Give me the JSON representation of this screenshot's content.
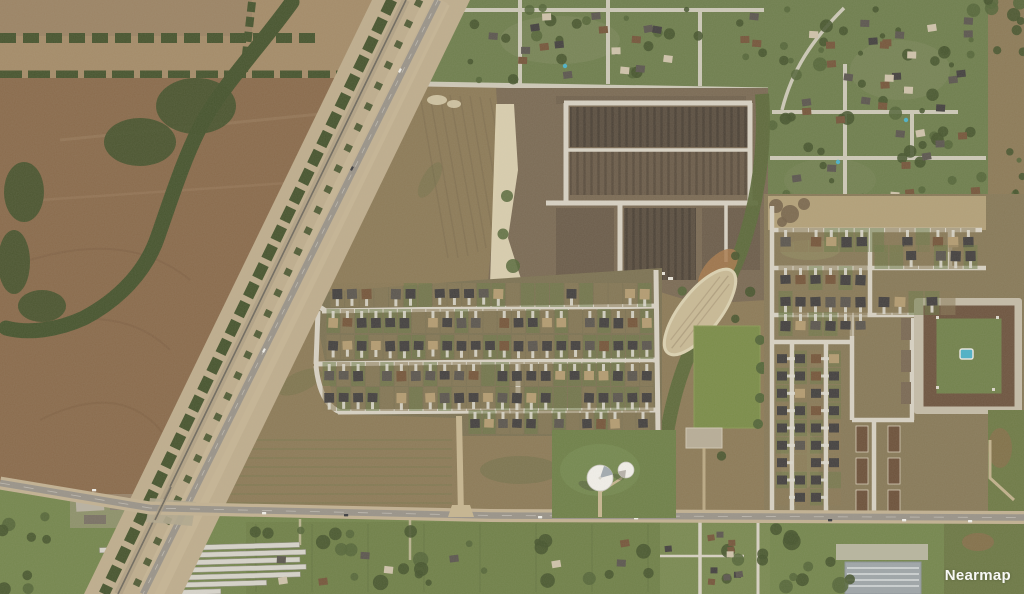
{
  "watermark": {
    "label": "Nearmap"
  },
  "map": {
    "type": "aerial-imagery",
    "scene": "suburban development: farmland, rail and road corridor, construction site, new subdivisions, water towers, east-west arterial road"
  },
  "palette": {
    "field_tan": "#a58c69",
    "field_tan2": "#9c8465",
    "field_brown": "#8a6b4c",
    "field_brown_dark": "#7d6043",
    "field_olive": "#8d7b58",
    "grass_green": "#6f7f4e",
    "lawn_green": "#6f8149",
    "sports_green": "#7b8d49",
    "tree_dark": "#47552f",
    "tree_mid": "#55673a",
    "scrub_olive": "#5e6c3c",
    "corridor_dirt": "#bfae8e",
    "ballast": "#b2a286",
    "rail_gray": "#6f6a5f",
    "road_asphalt": "#9a948a",
    "road_shoulder": "#c3b293",
    "street_light": "#d8d2c4",
    "dirt_road": "#c7b691",
    "construction_base": "#7b6b55",
    "construction_dark": "#5b4f41",
    "construction_mid": "#6c5d4b",
    "sand_pale": "#ded4b4",
    "detention_tan": "#c9ba96",
    "rust_dirt": "#a87a4e",
    "apt_pad": "#c5bca8",
    "apt_roof": "#6e5540",
    "courtyard": "#72824c",
    "pool_blue": "#4db2c8",
    "tower_white": "#f2f0ea",
    "tower_shadow": "#8e9aa3",
    "roof_dark": "#444140",
    "roof_gray": "#5c5750",
    "roof_brown": "#76573c",
    "roof_tan": "#b49c72",
    "roof_light": "#cfc3ab",
    "driveway": "#dcd8cd",
    "storage_roof": "#d7d4cb",
    "bldg_gray": "#9fa6a9",
    "south_green": "#75874e",
    "dirt_patch": "#8a6f4c",
    "watermark": "#ffffff"
  },
  "generated": {
    "house_rows": [
      {
        "x0": 330,
        "x1": 652,
        "y": 289,
        "n": 22,
        "face": "s",
        "skip": 0.28,
        "seed": 11
      },
      {
        "x0": 326,
        "x1": 654,
        "y": 318,
        "n": 23,
        "face": "n",
        "skip": 0.08,
        "seed": 12
      },
      {
        "x0": 326,
        "x1": 654,
        "y": 341,
        "n": 23,
        "face": "s",
        "skip": 0.08,
        "seed": 13
      },
      {
        "x0": 322,
        "x1": 654,
        "y": 371,
        "n": 23,
        "face": "n",
        "skip": 0.1,
        "seed": 14
      },
      {
        "x0": 322,
        "x1": 654,
        "y": 393,
        "n": 23,
        "face": "s",
        "skip": 0.1,
        "seed": 15
      },
      {
        "x0": 468,
        "x1": 650,
        "y": 419,
        "n": 13,
        "face": "n",
        "skip": 0.15,
        "seed": 16
      },
      {
        "x0": 778,
        "x1": 976,
        "y": 237,
        "n": 13,
        "face": "n",
        "skip": 0.35,
        "seed": 21
      },
      {
        "x0": 874,
        "x1": 978,
        "y": 251,
        "n": 7,
        "face": "s",
        "skip": 0.15,
        "seed": 22
      },
      {
        "x0": 778,
        "x1": 868,
        "y": 275,
        "n": 6,
        "face": "n",
        "skip": 0.1,
        "seed": 23
      },
      {
        "x0": 778,
        "x1": 868,
        "y": 297,
        "n": 6,
        "face": "s",
        "skip": 0.1,
        "seed": 24
      },
      {
        "x0": 876,
        "x1": 956,
        "y": 297,
        "n": 5,
        "face": "s",
        "skip": 0.2,
        "seed": 25
      },
      {
        "x0": 778,
        "x1": 868,
        "y": 321,
        "n": 6,
        "face": "n",
        "skip": 0.1,
        "seed": 26
      }
    ],
    "house_columns": [
      {
        "x": 782,
        "y0": 350,
        "y1": 506,
        "n": 9,
        "face": "e",
        "skip": 0.12,
        "seed": 31
      },
      {
        "x": 800,
        "y0": 350,
        "y1": 506,
        "n": 9,
        "face": "w",
        "skip": 0.12,
        "seed": 32
      },
      {
        "x": 816,
        "y0": 350,
        "y1": 506,
        "n": 9,
        "face": "e",
        "skip": 0.12,
        "seed": 33
      },
      {
        "x": 834,
        "y0": 350,
        "y1": 506,
        "n": 9,
        "face": "w",
        "skip": 0.12,
        "seed": 34
      }
    ],
    "tree_scatters": [
      {
        "x0": 458,
        "y0": 6,
        "x1": 764,
        "y1": 80,
        "n": 26,
        "rmin": 2.5,
        "rmax": 6,
        "seed": 41
      },
      {
        "x0": 772,
        "y0": 4,
        "x1": 984,
        "y1": 214,
        "n": 55,
        "rmin": 2.5,
        "rmax": 7,
        "seed": 42
      },
      {
        "x0": 988,
        "y0": 0,
        "x1": 1024,
        "y1": 52,
        "n": 9,
        "rmin": 3,
        "rmax": 7,
        "seed": 43
      },
      {
        "x0": 1002,
        "y0": 150,
        "x1": 1024,
        "y1": 228,
        "n": 7,
        "rmin": 2.5,
        "rmax": 5,
        "seed": 44
      },
      {
        "x0": 250,
        "y0": 525,
        "x1": 660,
        "y1": 592,
        "n": 26,
        "rmin": 3,
        "rmax": 8,
        "seed": 45
      },
      {
        "x0": 724,
        "y0": 528,
        "x1": 856,
        "y1": 592,
        "n": 15,
        "rmin": 4,
        "rmax": 9,
        "seed": 46
      },
      {
        "x0": 0,
        "y0": 515,
        "x1": 58,
        "y1": 592,
        "n": 8,
        "rmin": 3,
        "rmax": 7,
        "seed": 47
      },
      {
        "x0": 660,
        "y0": 252,
        "x1": 768,
        "y1": 456,
        "n": 14,
        "rmin": 3.5,
        "rmax": 6.5,
        "seed": 48
      }
    ],
    "building_scatters": [
      {
        "x0": 470,
        "y0": 12,
        "x1": 760,
        "y1": 74,
        "n": 20,
        "w": 9,
        "h": 7,
        "seed": 51
      },
      {
        "x0": 776,
        "y0": 10,
        "x1": 978,
        "y1": 208,
        "n": 38,
        "w": 9,
        "h": 7,
        "seed": 52
      },
      {
        "x0": 272,
        "y0": 540,
        "x1": 650,
        "y1": 588,
        "n": 9,
        "w": 9,
        "h": 7,
        "seed": 53
      },
      {
        "x0": 662,
        "y0": 530,
        "x1": 744,
        "y1": 588,
        "n": 11,
        "w": 7,
        "h": 6,
        "seed": 54
      }
    ],
    "pools": [
      [
        565,
        66
      ],
      [
        838,
        162
      ],
      [
        906,
        120
      ]
    ],
    "storage": {
      "x": 100,
      "y": 545,
      "rows": 7,
      "len": 200,
      "gap": 7.4,
      "h": 5
    },
    "cars_main": [
      [
        92,
        489
      ],
      [
        262,
        512
      ],
      [
        344,
        514
      ],
      [
        538,
        516
      ],
      [
        634,
        517
      ],
      [
        828,
        519
      ],
      [
        902,
        519
      ],
      [
        968,
        520
      ]
    ],
    "cars_corridor": [
      [
        398,
        72
      ],
      [
        350,
        170
      ],
      [
        262,
        352
      ]
    ]
  }
}
